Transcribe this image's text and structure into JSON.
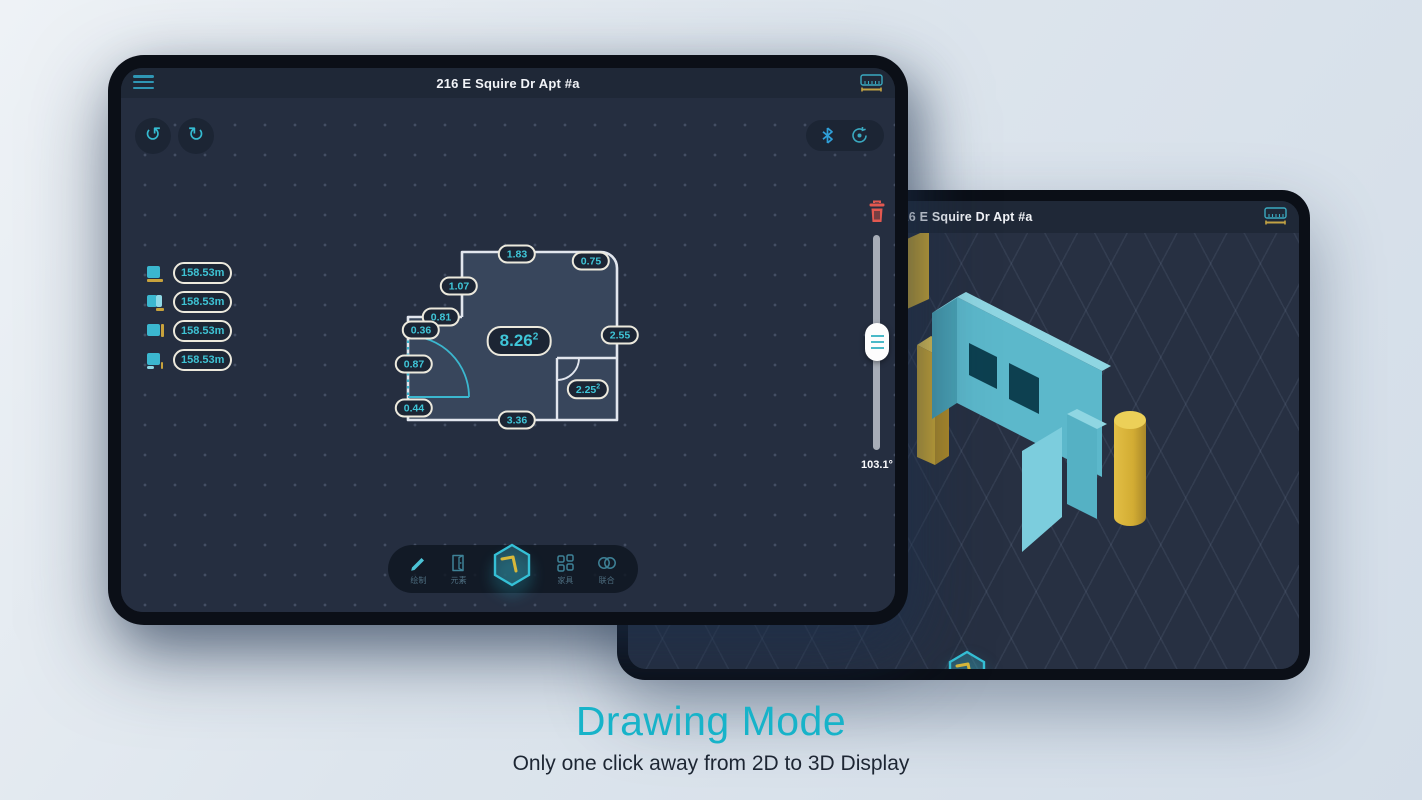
{
  "caption": {
    "title": "Drawing Mode",
    "subtitle": "Only one click away from 2D to 3D Display"
  },
  "tablet_front": {
    "title": "216 E Squire Dr Apt #a",
    "wall_list": [
      {
        "icon": "wall-bottom-edge-icon",
        "value": "158.53m"
      },
      {
        "icon": "wall-right-panel-icon",
        "value": "158.53m"
      },
      {
        "icon": "wall-right-edge-icon",
        "value": "158.53m"
      },
      {
        "icon": "wall-corner-edge-icon",
        "value": "158.53m"
      }
    ],
    "floorplan": {
      "area": {
        "value": "8.26",
        "sup": "2"
      },
      "small_area": {
        "value": "2.25",
        "sup": "2"
      },
      "measurements": {
        "top": "1.83",
        "top_right": "0.75",
        "upper_left": "1.07",
        "step": "0.81",
        "left_upper": "0.36",
        "door": "0.87",
        "left_lower": "0.44",
        "bottom": "3.36",
        "right": "2.55"
      }
    },
    "right_panel": {
      "angle": "103.1°"
    },
    "toolbar": {
      "items": [
        {
          "label": "绘制",
          "icon": "pencil-icon"
        },
        {
          "label": "元素",
          "icon": "door-icon"
        },
        {
          "label": "",
          "icon": "cube-3d-icon"
        },
        {
          "label": "家具",
          "icon": "grid-icon"
        },
        {
          "label": "联合",
          "icon": "merge-icon"
        }
      ]
    }
  },
  "tablet_back": {
    "title": "216 E Squire Dr Apt #a"
  },
  "colors": {
    "accent_teal": "#3bb7cf",
    "accent_yellow": "#d2ac33",
    "delete_red": "#e25850",
    "caption_teal": "#17b3c9",
    "badge_border": "#ece9dd",
    "canvas_bg": "#252e40"
  }
}
